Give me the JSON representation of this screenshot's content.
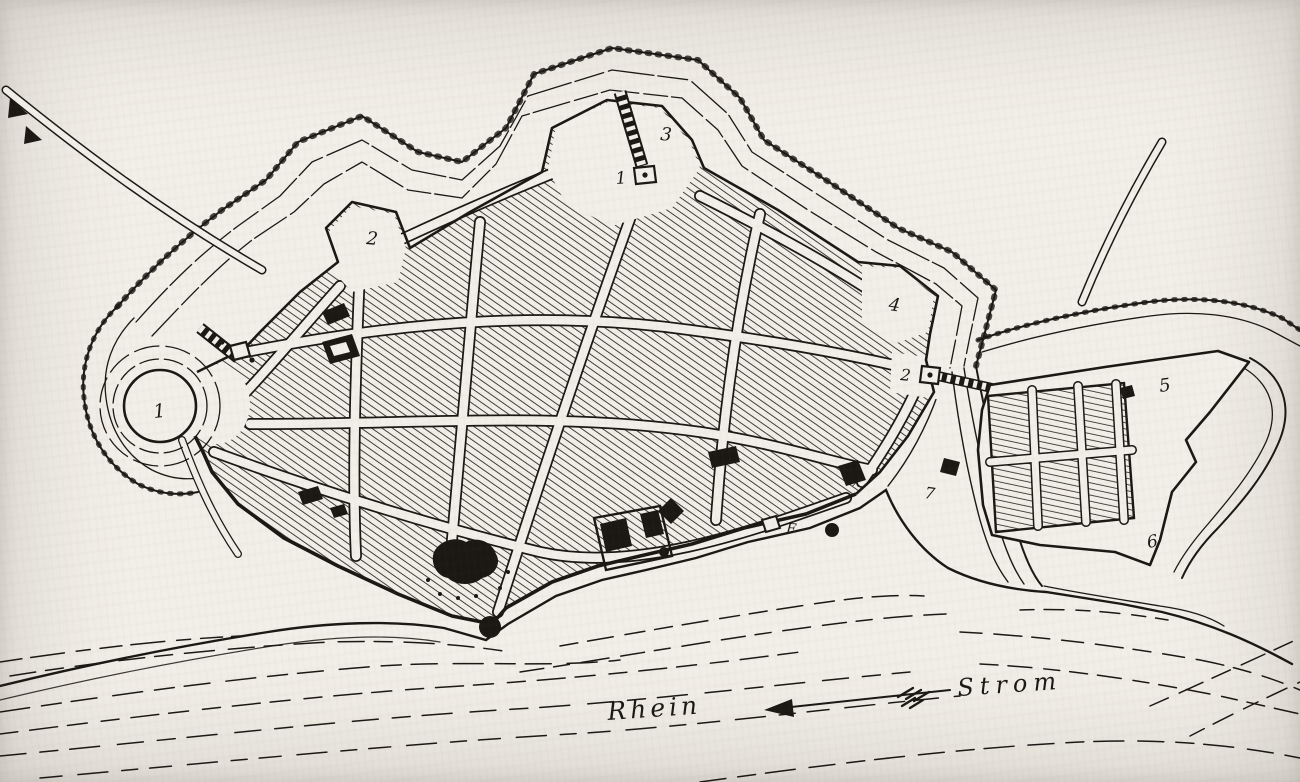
{
  "map": {
    "kind": "historical fortification plan (engraving)",
    "river": {
      "name": "Rhein",
      "flow_label": "Strom"
    },
    "labels": {
      "rondel": "1",
      "bastion_nw": "2",
      "bastion_north": "3",
      "bastion_east": "4",
      "fort_east": "5",
      "fort_south": "6",
      "gate_north": "1",
      "gate_east": "2",
      "mark_x": "x",
      "mark_7": "7",
      "mark_f": "F"
    },
    "colors": {
      "paper": "#f2efe8",
      "ink": "#1b1814"
    }
  }
}
